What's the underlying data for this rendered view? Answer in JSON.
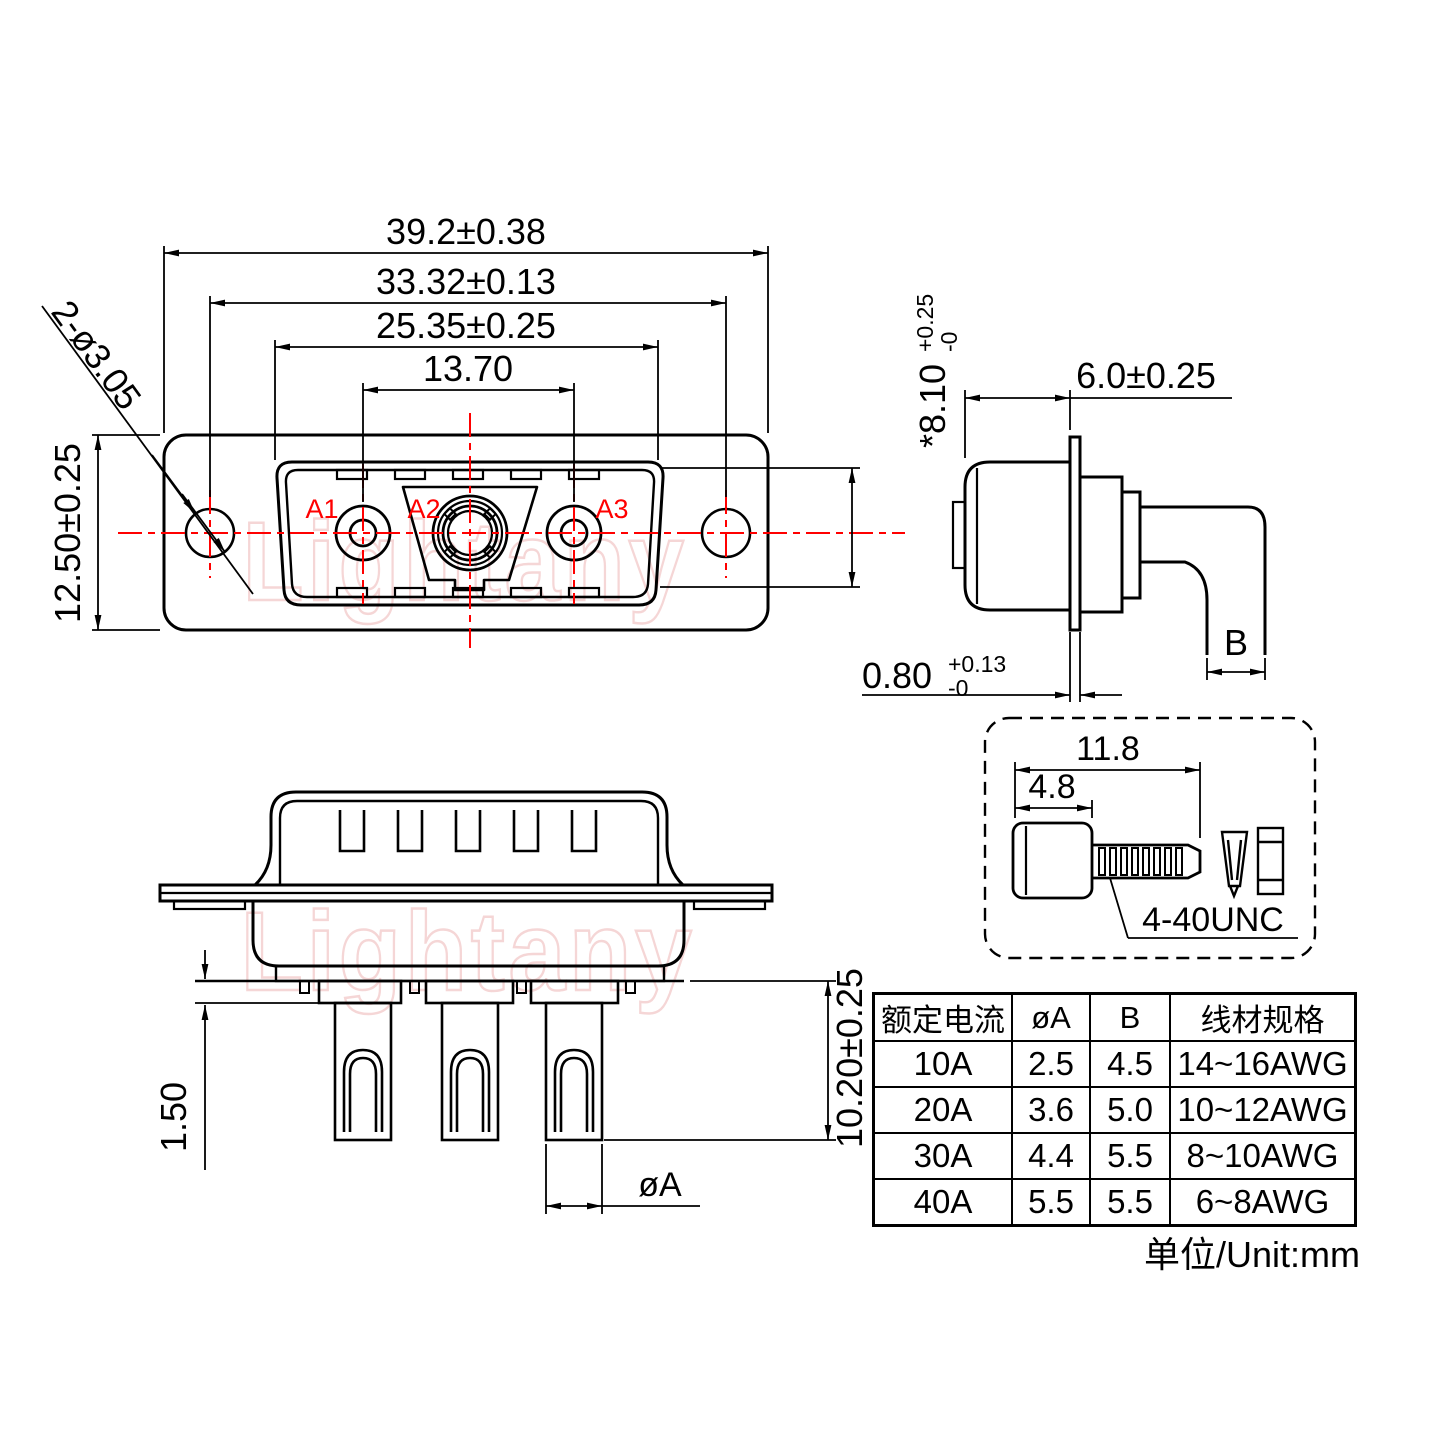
{
  "watermark": {
    "text": "Lightany"
  },
  "front_view": {
    "dim_width": "39.2±0.38",
    "dim_mount": "33.32±0.13",
    "dim_insert": "25.35±0.25",
    "dim_contacts": "13.70",
    "dim_height": "12.50±0.25",
    "dim_holes": "2-ø3.05",
    "dim_opening": "*8.10",
    "dim_opening_tol_up": "+0.25",
    "dim_opening_tol_dn": "-0",
    "contacts": {
      "a1": "A1",
      "a2": "A2",
      "a3": "A3"
    }
  },
  "side_view": {
    "dim_depth": "6.0±0.25",
    "dim_flange": "0.80",
    "dim_flange_tol_up": "+0.13",
    "dim_flange_tol_dn": "-0",
    "dim_wire": "B"
  },
  "screw_detail": {
    "dim_length": "11.8",
    "dim_head": "4.8",
    "thread_label": "4-40UNC"
  },
  "bottom_view": {
    "dim_plate": "1.50",
    "dim_cup_len": "10.20±0.25",
    "dim_cup_dia": "øA"
  },
  "spec_table": {
    "headers": [
      "额定电流",
      "øA",
      "B",
      "线材规格"
    ],
    "rows": [
      [
        "10A",
        "2.5",
        "4.5",
        "14~16AWG"
      ],
      [
        "20A",
        "3.6",
        "5.0",
        "10~12AWG"
      ],
      [
        "30A",
        "4.4",
        "5.5",
        "8~10AWG"
      ],
      [
        "40A",
        "5.5",
        "5.5",
        "6~8AWG"
      ]
    ]
  },
  "unit_note": "单位/Unit:mm",
  "colors": {
    "line": "#000000",
    "centerline": "#ff0000",
    "watermark": "#f0bcbc"
  }
}
